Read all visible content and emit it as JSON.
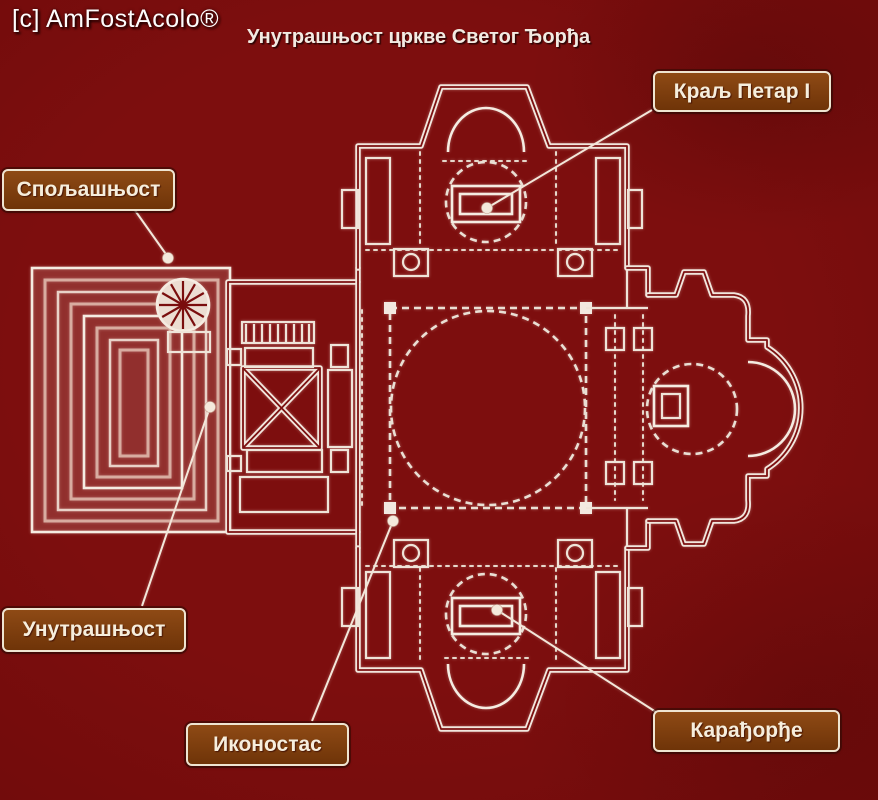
{
  "watermark": "[c] AmFostAcolo®",
  "title": "Унутрашњост цркве Светог Ђорђа",
  "callouts": {
    "spoljasnjost": "Спољашњост",
    "kralj_petar": "Краљ Петар I",
    "unutrasnjost": "Унутрашњост",
    "ikonostas": "Иконостас",
    "karadjordje": "Карађорђе"
  },
  "colors": {
    "background": "#7a0d0d",
    "plan_lines": "#f2e7de",
    "callout_fill": "#83400e",
    "callout_border": "#efe5d1",
    "callout_text": "#f6eedd",
    "title_text": "#f2eae2",
    "watermark_text": "#ffffff"
  }
}
